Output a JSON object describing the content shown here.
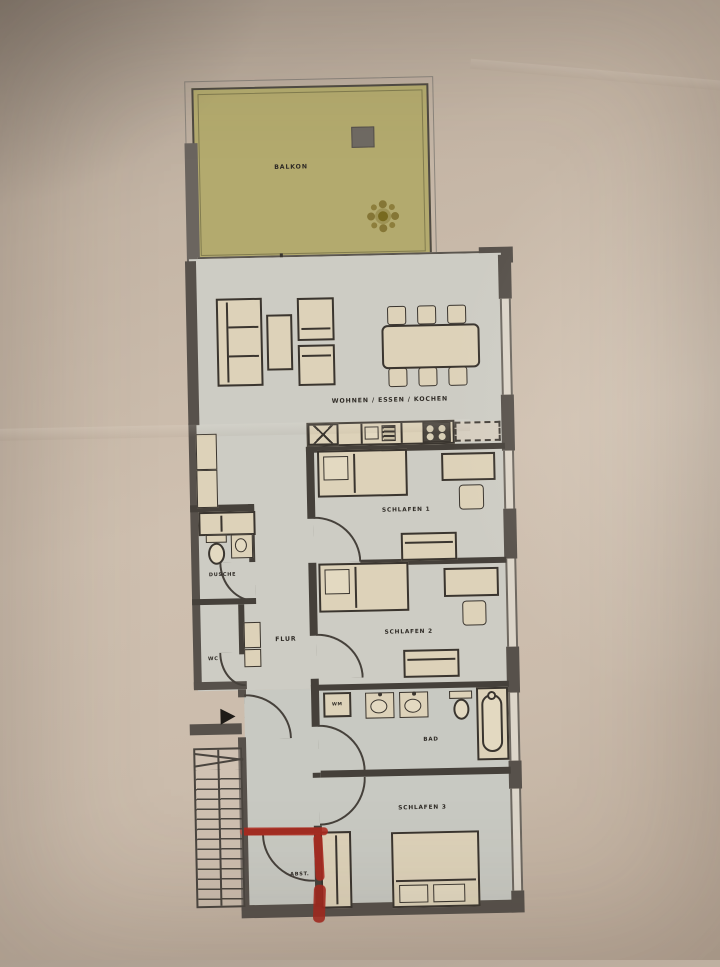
{
  "document": {
    "type": "apartment-floor-plan-photo"
  },
  "labels": {
    "balkon": "BALKON",
    "wohnen": "WOHNEN / ESSEN / KOCHEN",
    "schlafen1": "SCHLAFEN 1",
    "schlafen2": "SCHLAFEN 2",
    "schlafen3": "SCHLAFEN 3",
    "dusche": "DUSCHE",
    "wc": "WC",
    "flur": "FLUR",
    "bad": "BAD",
    "abst": "ABST.",
    "wm": "WM"
  },
  "colors": {
    "paper": "#c8b9a9",
    "balcony_floor": "#b3aa6e",
    "room_floor": "#c9c9c2",
    "furniture_fill": "#ddd2b9",
    "wall": "#57514b",
    "outline": "#3a352f",
    "annotation_red": "#b02a1f"
  },
  "icons": {
    "plant": "starburst-flower",
    "entrance_arrow": "right-triangle"
  },
  "annotations": {
    "red_marker": "hand-drawn red marker strokes on storage-room walls"
  }
}
